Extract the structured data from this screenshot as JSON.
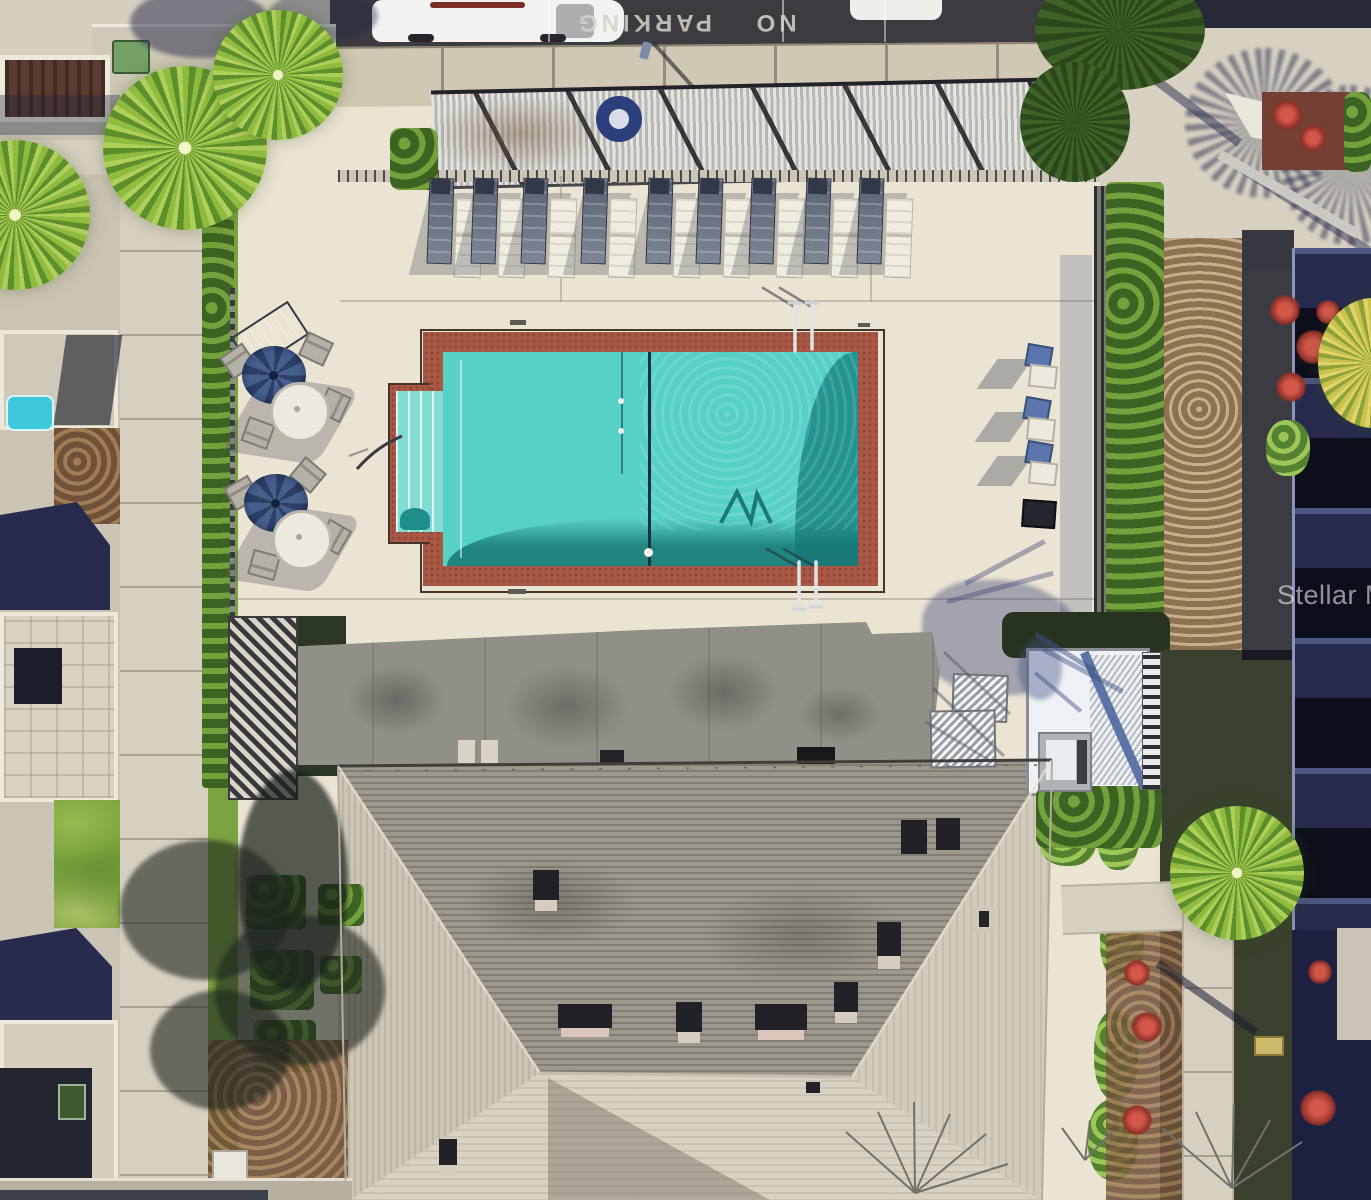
{
  "scene": {
    "type": "aerial-drone-photo",
    "subject": "Overhead view of a condominium community swimming pool, sun deck, landscaping and clubhouse roof",
    "watermark": {
      "text": "Stellar MLS"
    },
    "parking": {
      "pavement_text": "NO PARKING",
      "cars_visible": 2
    },
    "pool": {
      "shape": "rectangle with left step alcove",
      "lounger_pairs": 9,
      "patio_table_sets": 2,
      "umbrellas": 2,
      "side_chairs": 3,
      "ladders": 2,
      "lane_lines": 1,
      "life_rings": 1
    },
    "colors": {
      "deck": "#eae4d3",
      "deck-shadow": "#8f9087",
      "walkway": "#d6d0c0",
      "curb": "#cfc8b2",
      "asphalt": "#3b3b40",
      "pool-water": "#57d1c5",
      "pool-deep": "#1f8e8b",
      "pool-steps": "#83dcd2",
      "pool-trim": "#a85844",
      "roof-shade": "#9c988b",
      "roof-lit": "#d8d2c2",
      "roof-left": "#ccc6b6",
      "roof-right": "#d2ccbc",
      "grass": "#7aa23e",
      "palm": "#8fbc3f",
      "palm-dark": "#3f6326",
      "hedge": "#4e7f2c",
      "mulch": "#8a6a4c",
      "gravel": "#b59a76",
      "shadow-blue": "#2d3450",
      "building-dark": "#262b4e",
      "umbrella": "#46608e",
      "metal-roof": "#eef1f4",
      "flower-red": "#c4473c",
      "chair-white": "#efece0",
      "chair-dark": "#5a6372",
      "fence-dark": "#2c2e33"
    }
  }
}
